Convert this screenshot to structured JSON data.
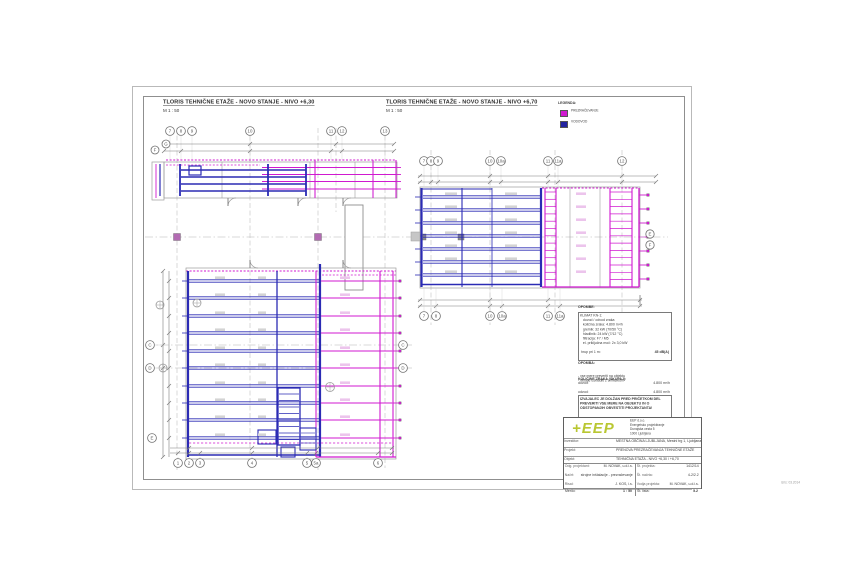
{
  "colors": {
    "magenta": "#d019d0",
    "blue": "#2b2bb4",
    "grid_grey": "#9a9a9a",
    "logo_green": "#b9c732",
    "column_purple": "#b36bb3"
  },
  "titles": {
    "plan1": {
      "title": "TLORIS TEHNIČNE ETAŽE - NOVO STANJE - NIVO +6,30",
      "scale": "M 1 : 50"
    },
    "plan2": {
      "title": "TLORIS TEHNIČNE ETAŽE - NOVO STANJE - NIVO +6,70",
      "scale": "M 1 : 50"
    }
  },
  "legend": {
    "title": "LEGENDA:",
    "items": [
      {
        "label": "PREZRAČEVANJE",
        "color": "#d019d0"
      },
      {
        "label": "VODOVOD",
        "color": "#2323a0"
      }
    ]
  },
  "grid_bubbles": {
    "plan1_top": [
      "7",
      "8",
      "9",
      "10",
      "11",
      "12",
      "13"
    ],
    "plan1_left": [
      "F",
      "G"
    ],
    "plan2_top": [
      "7",
      "8",
      "9",
      "10",
      "10a",
      "11",
      "11a",
      "12"
    ],
    "plan2_bottom": [
      "7",
      "8",
      "10",
      "10a",
      "11",
      "11a"
    ],
    "plan2_right": [
      "E",
      "F"
    ],
    "plan3_left": [
      "C",
      "D",
      "E"
    ],
    "plan3_right": [
      "C",
      "D"
    ],
    "plan3_bottom": [
      "1",
      "2",
      "3",
      "4",
      "5",
      "5a",
      "6"
    ]
  },
  "notes": {
    "header": "OPOMBE:",
    "box1_lines": [
      "KLIMAT KN-1:",
      "   dovod / odvod zraka",
      "   količina zraka: 4.800 m³/h",
      "   grelnik: 32 kW (70/50 °C)",
      "   hladilnik: 24 kW (7/12 °C)",
      "   filtracija: F7 / M5",
      "   el. priključna moč: 2x 3,0 kW"
    ],
    "box1_value_label": "hrup pri 1 m:",
    "box1_value": "45 dB(A)",
    "box1_footer": "vse kanale obesiti s tipskimi obešali",
    "group1": {
      "header": "OPOMBA:",
      "items": [
        "- vse mere preveriti na objektu",
        "- detajle uskladiti z arhitektom"
      ]
    },
    "group2": {
      "header": "KOLIČINE ZRAKA (SKUPAJ):",
      "rows": [
        [
          "dovod:",
          "4.800 m³/h"
        ],
        [
          "odvod:",
          "4.800 m³/h"
        ],
        [
          "odtok san.:",
          "1.200 m³/h"
        ]
      ]
    },
    "warning_lines": [
      "IZVAJALEC JE DOLŽAN PRED PRIČETKOM DEL",
      "PREVERITI VSE MERE NA OBJEKTU IN O",
      "ODSTOPANJIH OBVESTITI PROJEKTANTA!"
    ]
  },
  "titleblock": {
    "logo": "+EEP",
    "company_lines": [
      "EEP d.o.o.",
      "Energetsko projektiranje",
      "Dunajska cesta 5",
      "1000 Ljubljana"
    ],
    "rows": [
      {
        "label": "Investitor:",
        "value": "MESTNA OBČINA LJUBLJANA, Mestni trg 1, Ljubljana"
      },
      {
        "label": "Projekt:",
        "value": "PRENOVA PREZRAČEVANJA TEHNIČNE ETAŽE"
      },
      {
        "label": "Objekt:",
        "value": "TEHNIČNA ETAŽA - NIVO +6,30 / +6,70"
      }
    ],
    "left_col": [
      [
        "Odg. projektant:",
        "M. NOVAK, u.d.i.s."
      ],
      [
        "Načrt:",
        "strojne inštalacije - prezračevanje"
      ],
      [
        "Risal:",
        "J. KOS, i.s."
      ],
      [
        "Datum:",
        "03.2014"
      ]
    ],
    "right_col": [
      [
        "Št. projekta:",
        "1412/14"
      ],
      [
        "Št. načrta:",
        "4-2/2.2"
      ],
      [
        "Vodja projekta:",
        "M. NOVAK, u.d.i.s."
      ],
      [
        "Datum:",
        "03.2014"
      ]
    ],
    "merilo_label": "Merilo:",
    "merilo_value": "1 : 50",
    "list_label": "Št. lista:",
    "list_value": "5.2",
    "plot_stamp": "izris: 03.2014"
  }
}
